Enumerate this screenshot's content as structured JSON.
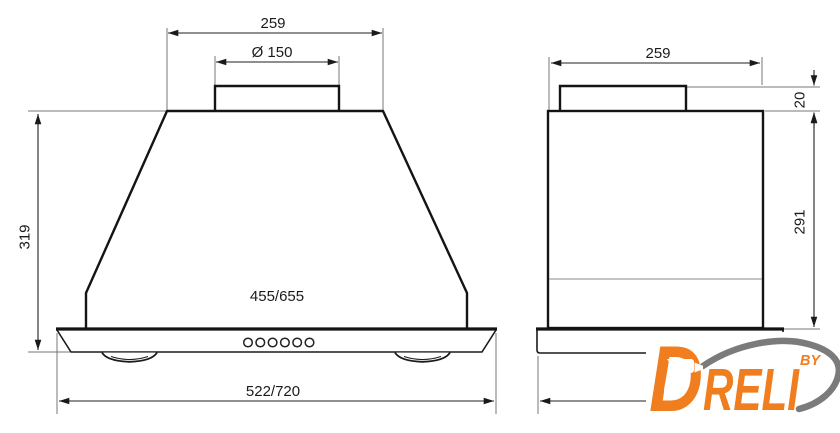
{
  "page": {
    "background": "#ffffff"
  },
  "drawing": {
    "title": "Cooker hood dimensional drawing, front and side views",
    "line_color": "#1a1a1a",
    "extension_line_color": "#777777",
    "views": {
      "front": {
        "dims": {
          "top_width": "259",
          "duct_diameter": "Ø 150",
          "height": "319",
          "body_width": "455/655",
          "total_width": "522/720"
        },
        "buttons_count": "6"
      },
      "side": {
        "dims": {
          "top_width": "259",
          "duct_height": "20",
          "body_height": "291"
        }
      }
    }
  },
  "logo": {
    "brand_initial": "D",
    "brand_rest": "RELI",
    "by_label": "BY",
    "orange": "#F07E1E",
    "swoosh_gray": "#7B7B7B",
    "icon": "drill-icon"
  }
}
